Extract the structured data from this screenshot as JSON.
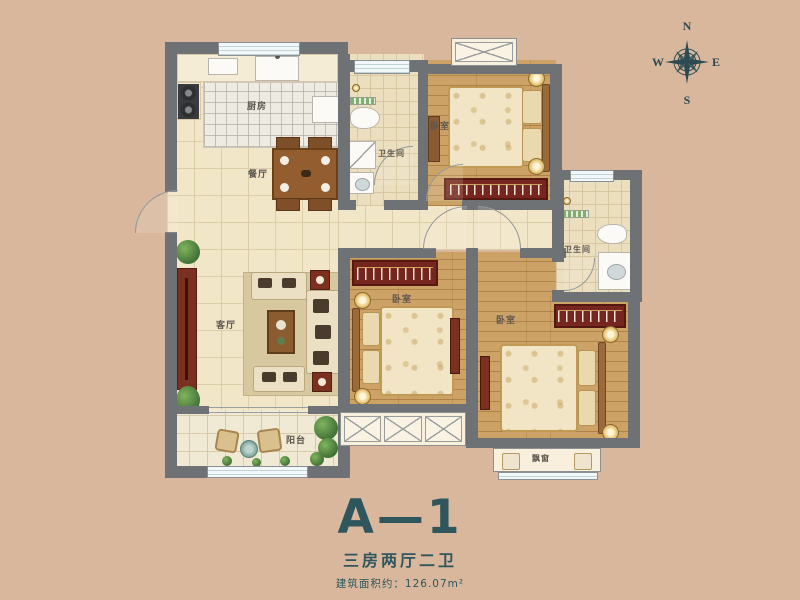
{
  "title": {
    "name": "A—1",
    "type_text": "三房两厅二卫",
    "area_text": "建筑面积约：126.07m²"
  },
  "compass": {
    "n": "N",
    "e": "E",
    "s": "S",
    "w": "W"
  },
  "rooms": {
    "kitchen": {
      "label": "厨房"
    },
    "dining": {
      "label": "餐厅"
    },
    "living": {
      "label": "客厅"
    },
    "bedroom1": {
      "label": "卧室"
    },
    "bedroom2": {
      "label": "卧室"
    },
    "bedroom3": {
      "label": "卧室"
    },
    "bath1": {
      "label": "卫生间"
    },
    "bath2": {
      "label": "卫生间"
    },
    "balcony": {
      "label": "阳台"
    },
    "baywindow": {
      "label": "飘窗"
    }
  },
  "colors": {
    "background": "#d8b79d",
    "wall": "#6f7275",
    "accent_teal": "#2e565c",
    "wood_floor": "#cda266",
    "wardrobe_red": "#76261e"
  }
}
